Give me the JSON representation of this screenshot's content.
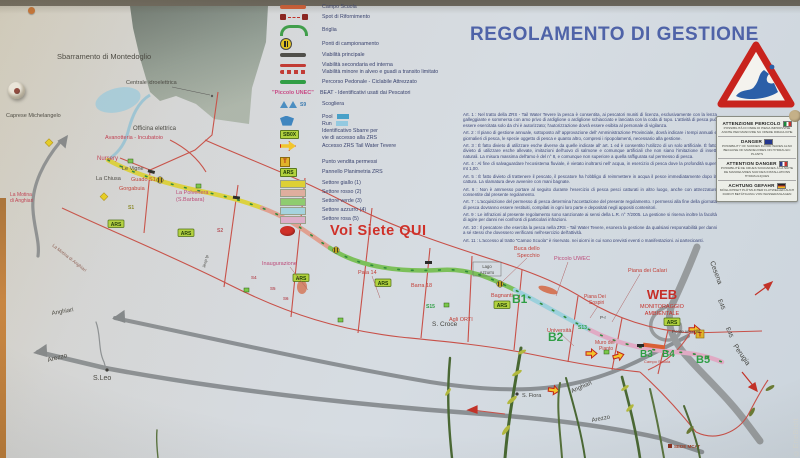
{
  "photo": {
    "watermark": "©EneBiott"
  },
  "legend": {
    "campo_scuola": "Campo Scuola",
    "spot": "Spot di Rifornimento",
    "briglia": "Briglia",
    "ponti": "Ponti di campionamento",
    "viab_princ": "Viabilità principale",
    "viab_sec": "Viabilità secondaria ed interna",
    "viab_min": "Viabilità minore in alveo e guadi a transito limitato",
    "percorso": "Percorso Pedonale - Ciclabile Attrezzato",
    "unec": "\"Piccolo UNEC\"",
    "beat": "BEAT - Identificativi usati dai Pescatori",
    "scogliera": "Scogliera",
    "s9": "S9",
    "pool": "Pool",
    "run": "Run",
    "sb_icon": "SB0X",
    "sbarre1": "Identificativo Sbarre per",
    "sbarre2": "vie di accesso alla ZRS",
    "accesso": "Accesso ZRS Tail Water Tevere",
    "t_icon": "T",
    "punto_vendita": "Punto vendita permessi",
    "ars_icon": "ARS",
    "pannello": "Pannello Planimetria ZRS",
    "settori": [
      "Settore giallo (1)",
      "Settore rosso (2)",
      "Settore verde (3)",
      "Settore azzurro (4)",
      "Settore rosa (5)"
    ],
    "you_are_here": "Voi Siete QUI"
  },
  "regolamento": {
    "title": "REGOLAMENTO DI GESTIONE",
    "articles": [
      "Art. 1 : Nel tratto della ZRS - Tail Water Tevere la pesca è consentita, ai pescatori muniti di licenza, esclusivamente con la lenza galleggiante e sommersa con amo privo di ardiglione o ardiglione schiacciato e lanciata con la coda di topo. L'attività di pesca può essere esercitata solo da chi è autorizzato; l'autorizzazione dovrà essere esibita al personale di vigilanza.",
      "Art. 2 : Il piano di gestione annuale, sottoposto all' approvazione dell' Amministrazione Provinciale, dovrà indicare i tempi annuali e giornalieri di pesca, le specie oggetto di pesca e quanto altro, compresi i ripopolamenti, necessario alla gestione.",
      "Art. 3 : È fatto divieto di utilizzare esche diverse da quelle indicate all' art. 1 ed è consentito l'utilizzo di un solo artificiale. È fatto divieto di utilizzare esche allevate, imitazioni dell'uovo di salmone e comunque artificiali che non siano l'imitazione di insetti naturali. La misura massima dell'amo è del n° 8, e comunque non superiore a quella raffigurata sul permesso di pesca.",
      "Art. 4 : Al fine di salvaguardare l'ecosistema fluviale, è vietato inoltrarsi nell' acqua, in esercizio di pesca dove la profondità superi mt 1,00.",
      "Art. 5 : È fatto divieto di trattenere il pescato, il pescatore ha l'obbligo di reimmettere in acqua il pesce immediatamente dopo la cattura. La slamatura deve avvenire con mani bagnate.",
      "Art. 6 : Non è ammesso portare al seguito durante l'esercizio di pesca pesci catturati in altro luogo, anche con attrezzature consentite dal presente regolamento.",
      "Art. 7 : L'acquisizione del permesso di pesca determina l'accettazione del presente regolamento. I permessi alla fine della giornata di pesca dovranno essere restituiti, compilati in ogni loro parte e depositati negli appositi contenitori.",
      "Art. 9 : Le infrazioni al presente regolamento sono sanzionate ai sensi della L.R. n° 7/2005. La gestione si riserva inoltre la facoltà di agire per danni nei confronti di particolari infrazioni.",
      "Art. 10 : Il pescatore che esercita la pesca nella ZRS - Tail Water Tevere, esonera la gestione da qualsiasi responsabilità per danni a sé stessi che dovessero verificarsi nell'esercizio dell'attività.",
      "Art. 11 : L'accesso al tratto \"Campo Scuola\" è riservato, nei giorni in cui sono previsti eventi o manifestazioni, ai partecipanti."
    ]
  },
  "warning": {
    "sections": [
      {
        "title": "ATTENZIONE PERICOLO",
        "body": "POSSIBILITÀ DI ONDE DI PIENA IMPROVVISE ANCHE PER MANOVRE SU OPERE IDRAULICHE"
      },
      {
        "title": "DANGER",
        "body": "POSSIBILITY OF SUDDEN FLOOD WAVES ALSO BECAUSE OF MANOEUVRES ON HYDRAULIC PLANTS"
      },
      {
        "title": "ATTENTION DANGER",
        "body": "POSSIBILITÉ DE CRUES SOUDAINES À LA SUITE DE MANOEUVRES SUR DES INSTALLATIONS HYDRAULIQUES"
      },
      {
        "title": "ACHTUNG GEFAHR",
        "body": "MÖGLICHKEIT PLÖTZLICHER FLUTWELLEN AUCH DURCH BETÄTIGUNG VON WASSERANLAGEN"
      }
    ]
  },
  "map": {
    "sbarramento": "Sbarramento di Montedoglio",
    "centrale": "Centrale idroelettrica",
    "caprese": "Caprese Michelangelo",
    "officina": "Officina elettrica",
    "avanotteria": "Avanotteria - Incubatoio",
    "nursery": "Nursery",
    "le_vigne": "Le Vigne",
    "la_chiusa": "La Chiusa",
    "guado_s1": "Guado S1",
    "gorgabuia": "Gorgabuia",
    "polveriera1": "La Polveriera",
    "polveriera2": "(S.Barbara)",
    "motina1": "La Motina",
    "motina2": "di Anghiari",
    "motina_road": "La Motina di Anghiari",
    "jeep": "Jeep tp",
    "anghiari_left": "Anghiari",
    "arezzo_left": "Arezzo",
    "s_leo": "S.Leo",
    "inaugurazione": "Inaugurazione",
    "pala14": "Pala 14",
    "barra18": "Barra 18",
    "buca1": "Buca dello",
    "buca2": "Specchio",
    "piccolo_uwec": "Piccolo UWEC",
    "piana_calari": "Piana dei Calari",
    "lago1": "Lago",
    "lago2": "Azzurro",
    "bagnanti": "Bagnanti",
    "agli_orti": "Agli ORTI",
    "s_croce": "S. Croce",
    "universita": "Università",
    "sospiri1": "Piana Dei",
    "sospiri2": "Sospiri",
    "muro1": "Muro del",
    "muro2": "Pianto",
    "web": "WEB",
    "web2": "MONITORAGGIO",
    "web3": "AMBIENTALE",
    "ponte_vecchio": "Ponte vecchio",
    "campo_scuola": "Campo Scuola",
    "s_fiora": "S. Fiora",
    "anghiari_road": "Anghiari",
    "arezzo_road": "Arezzo",
    "cesena": "Cesena",
    "e45a": "E45",
    "e45b": "E45",
    "perugia": "Perugia",
    "p_r": "P-r",
    "sede_mcat": "SEDE MCAT",
    "ars": "ARS",
    "sb": "SB0X",
    "t": "T",
    "b1": "B1",
    "b2": "B2",
    "b3": "B3",
    "b4": "B4",
    "b5": "B5",
    "s1": "S1",
    "s2": "S2",
    "s4": "S4",
    "s5": "S5",
    "s6": "S6",
    "s13": "S13",
    "s15": "S15"
  }
}
